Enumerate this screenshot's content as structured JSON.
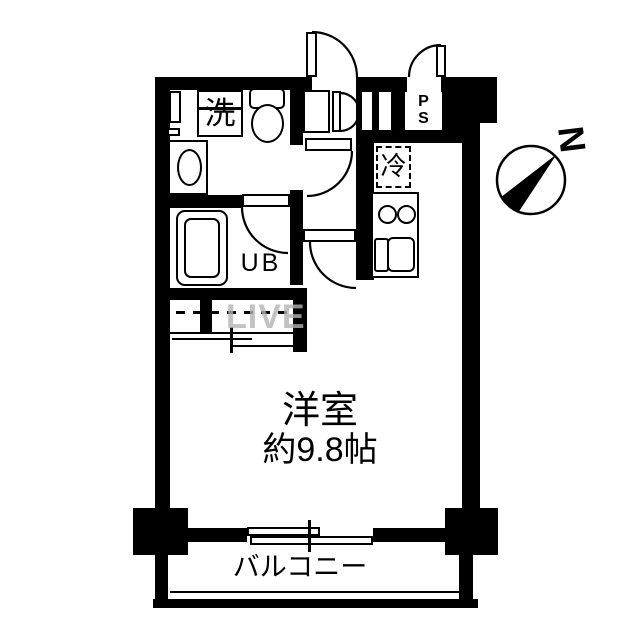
{
  "labels": {
    "laundry": "洗",
    "unit_bath": "UB",
    "pipe_space_line1": "P",
    "pipe_space_line2": "S",
    "refrigerator": "冷",
    "room_name": "洋室",
    "room_size": "約9.8帖",
    "balcony": "バルコニー",
    "compass_north": "N",
    "watermark": "LIVE"
  },
  "colors": {
    "wall": "#000000",
    "background": "#ffffff",
    "watermark_gray": "#b4b4b4"
  }
}
